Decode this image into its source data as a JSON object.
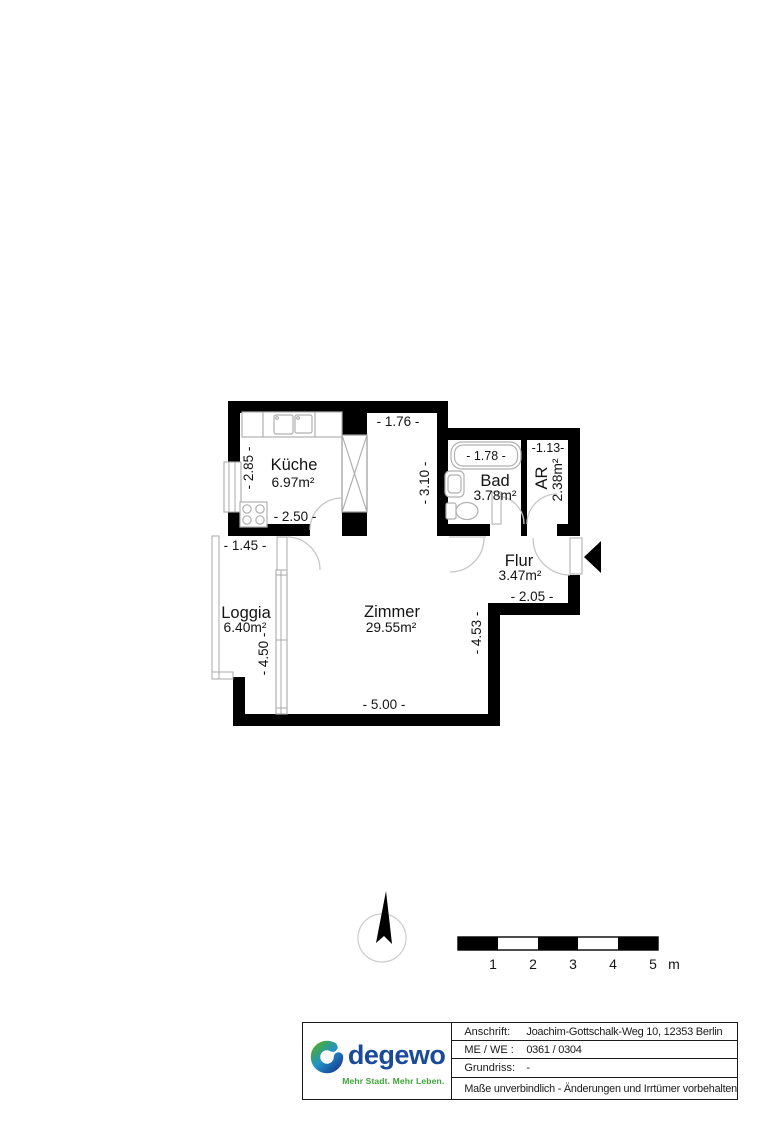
{
  "floor_plan": {
    "rooms": {
      "kueche": {
        "name": "Küche",
        "area": "6.97m²"
      },
      "bad": {
        "name": "Bad",
        "area": "3.78m²"
      },
      "ar": {
        "name": "AR",
        "area": "2.38m²"
      },
      "flur": {
        "name": "Flur",
        "area": "3.47m²"
      },
      "zimmer": {
        "name": "Zimmer",
        "area": "29.55m²"
      },
      "loggia": {
        "name": "Loggia",
        "area": "6.40m²"
      }
    },
    "dimensions": {
      "corridor_width": "- 1.76 -",
      "kueche_height": "- 2.85 -",
      "kueche_width": "- 2.50 -",
      "corridor_height": "- 3.10 -",
      "bathtub_width": "- 1.78 -",
      "ar_width": "-1.13-",
      "loggia_width": "- 1.45 -",
      "flur_width": "- 2.05 -",
      "zimmer_height": "- 4.53 -",
      "loggia_height": "- 4.50 -",
      "zimmer_width": "- 5.00 -"
    },
    "wall_color": "#000000",
    "fixture_line_color": "#b0b0b0"
  },
  "scale_bar": {
    "ticks": [
      "1",
      "2",
      "3",
      "4",
      "5"
    ],
    "unit": "m"
  },
  "title_block": {
    "fields": [
      {
        "label": "Anschrift:",
        "value": "Joachim-Gottschalk-Weg 10, 12353 Berlin"
      },
      {
        "label": "ME / WE :",
        "value": "0361 / 0304"
      },
      {
        "label": "Grundriss:",
        "value": "-"
      }
    ],
    "disclaimer": "Maße unverbindlich - Änderungen und Irrtümer vorbehalten",
    "logo": {
      "wordmark": "degewo",
      "tagline": "Mehr Stadt. Mehr Leben.",
      "brand_blue": "#1b4a9b",
      "brand_green": "#3ea53a"
    }
  }
}
